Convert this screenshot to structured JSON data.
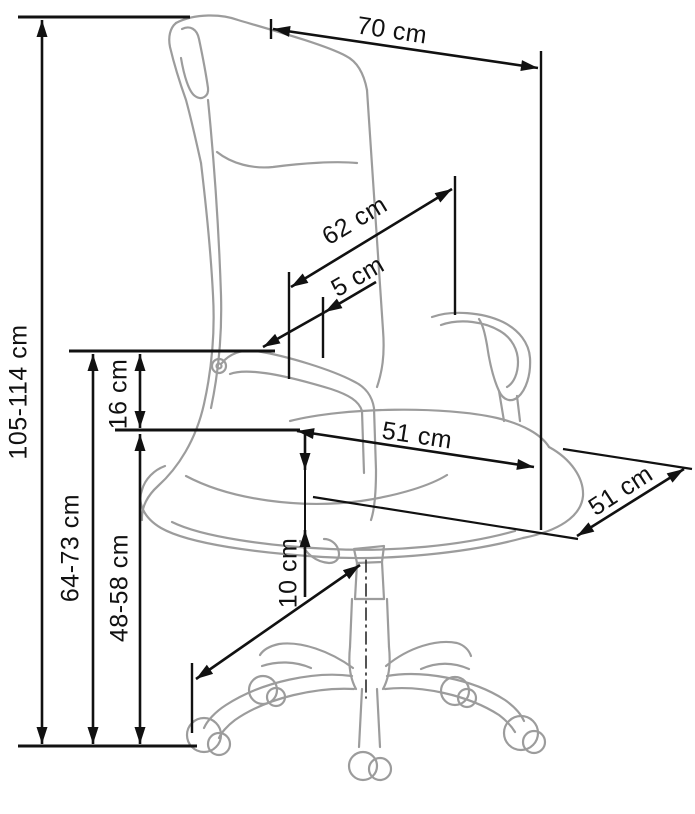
{
  "diagram": {
    "subject": "office chair side-view dimension drawing",
    "unit": "cm",
    "labels": {
      "overall_height": "105-114 cm",
      "top_depth": "70 cm",
      "backrest_height": "62 cm",
      "backrest_offset": "5 cm",
      "armrest_height": "64-73 cm",
      "seat_to_armrest": "16 cm",
      "seat_height": "48-58 cm",
      "seat_width": "51 cm",
      "seat_depth": "51 cm",
      "height_adjustment": "10 cm"
    }
  }
}
